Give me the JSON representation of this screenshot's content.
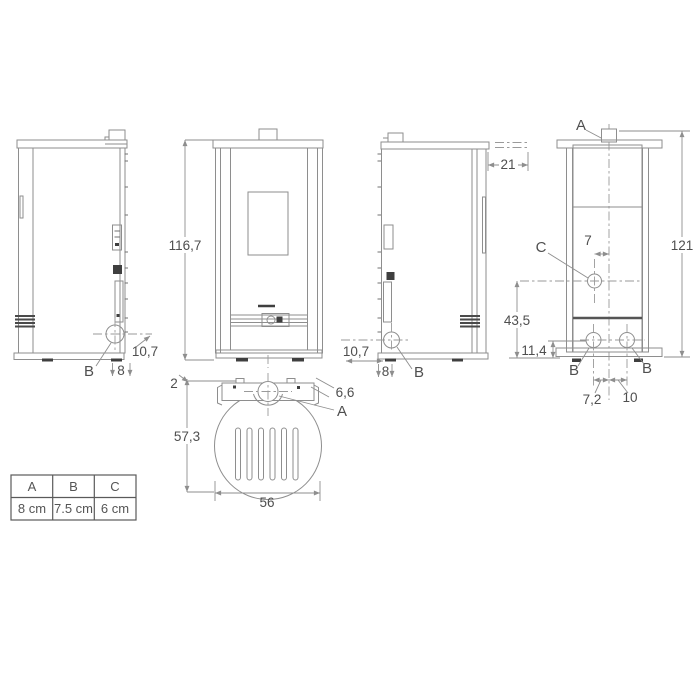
{
  "views": {
    "side_left": {
      "hole_label": "B",
      "dim_base": "8",
      "dim_flue_depth": "10,7"
    },
    "front": {
      "dim_height": "116,7"
    },
    "top": {
      "dim_rear_gap": "2",
      "dim_flue_offset": "6,6",
      "flue_label": "A",
      "dim_depth": "57,3",
      "dim_width": "56"
    },
    "side_right": {
      "dim_flue_center": "21",
      "dim_flue_depth": "10,7",
      "dim_base": "8",
      "hole_label": "B"
    },
    "rear": {
      "flue_label": "A",
      "dim_total_height": "121",
      "hole_c_label": "C",
      "dim_c_to_center": "7",
      "dim_c_height": "43,5",
      "dim_b_height": "11,4",
      "hole_b_left": "B",
      "hole_b_right": "B",
      "dim_b_left_to_center": "7,2",
      "dim_b_right_to_center": "10"
    },
    "legend_table": {
      "headers": [
        "A",
        "B",
        "C"
      ],
      "values": [
        "8 cm",
        "7.5 cm",
        "6 cm"
      ]
    }
  },
  "legend_table": {
    "headers": [
      "A",
      "B",
      "C"
    ],
    "values": [
      "8 cm",
      "7.5 cm",
      "6 cm"
    ]
  },
  "colors": {
    "line": "#8e8e8e",
    "dark": "#3f3f3f",
    "text": "#4f4f4f",
    "table_border": "#5a5a5a",
    "background": "#ffffff"
  }
}
